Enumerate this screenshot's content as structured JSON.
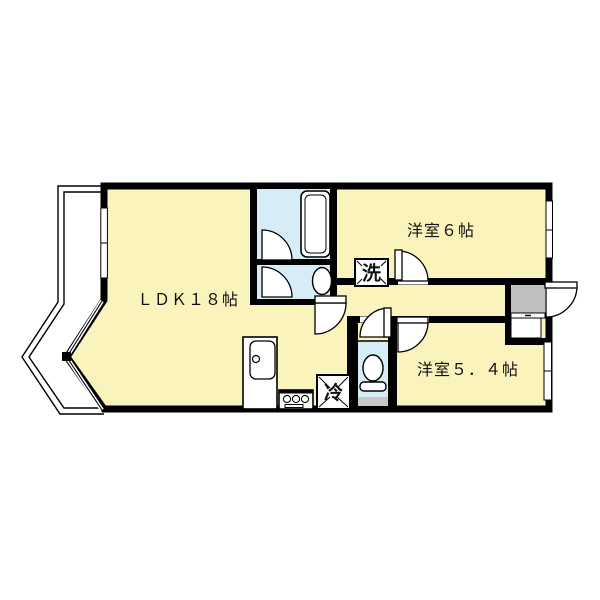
{
  "plan": {
    "type": "apartment-floorplan",
    "rooms": {
      "ldk": {
        "label": "ＬＤＫ１８帖"
      },
      "bedroom_6": {
        "label": "洋室６帖"
      },
      "bedroom_5_4": {
        "label": "洋室５．４帖"
      }
    },
    "fixtures": {
      "washer": {
        "label": "洗"
      },
      "fridge": {
        "label": "冷"
      }
    },
    "colors": {
      "room_fill": "#FAF3BB",
      "wet_area_fill": "#D6ECF7",
      "entry_fill": "#BFBFBF",
      "counter_gray": "#C8C8C8",
      "wall": "#000000",
      "background": "#FFFFFF"
    }
  }
}
